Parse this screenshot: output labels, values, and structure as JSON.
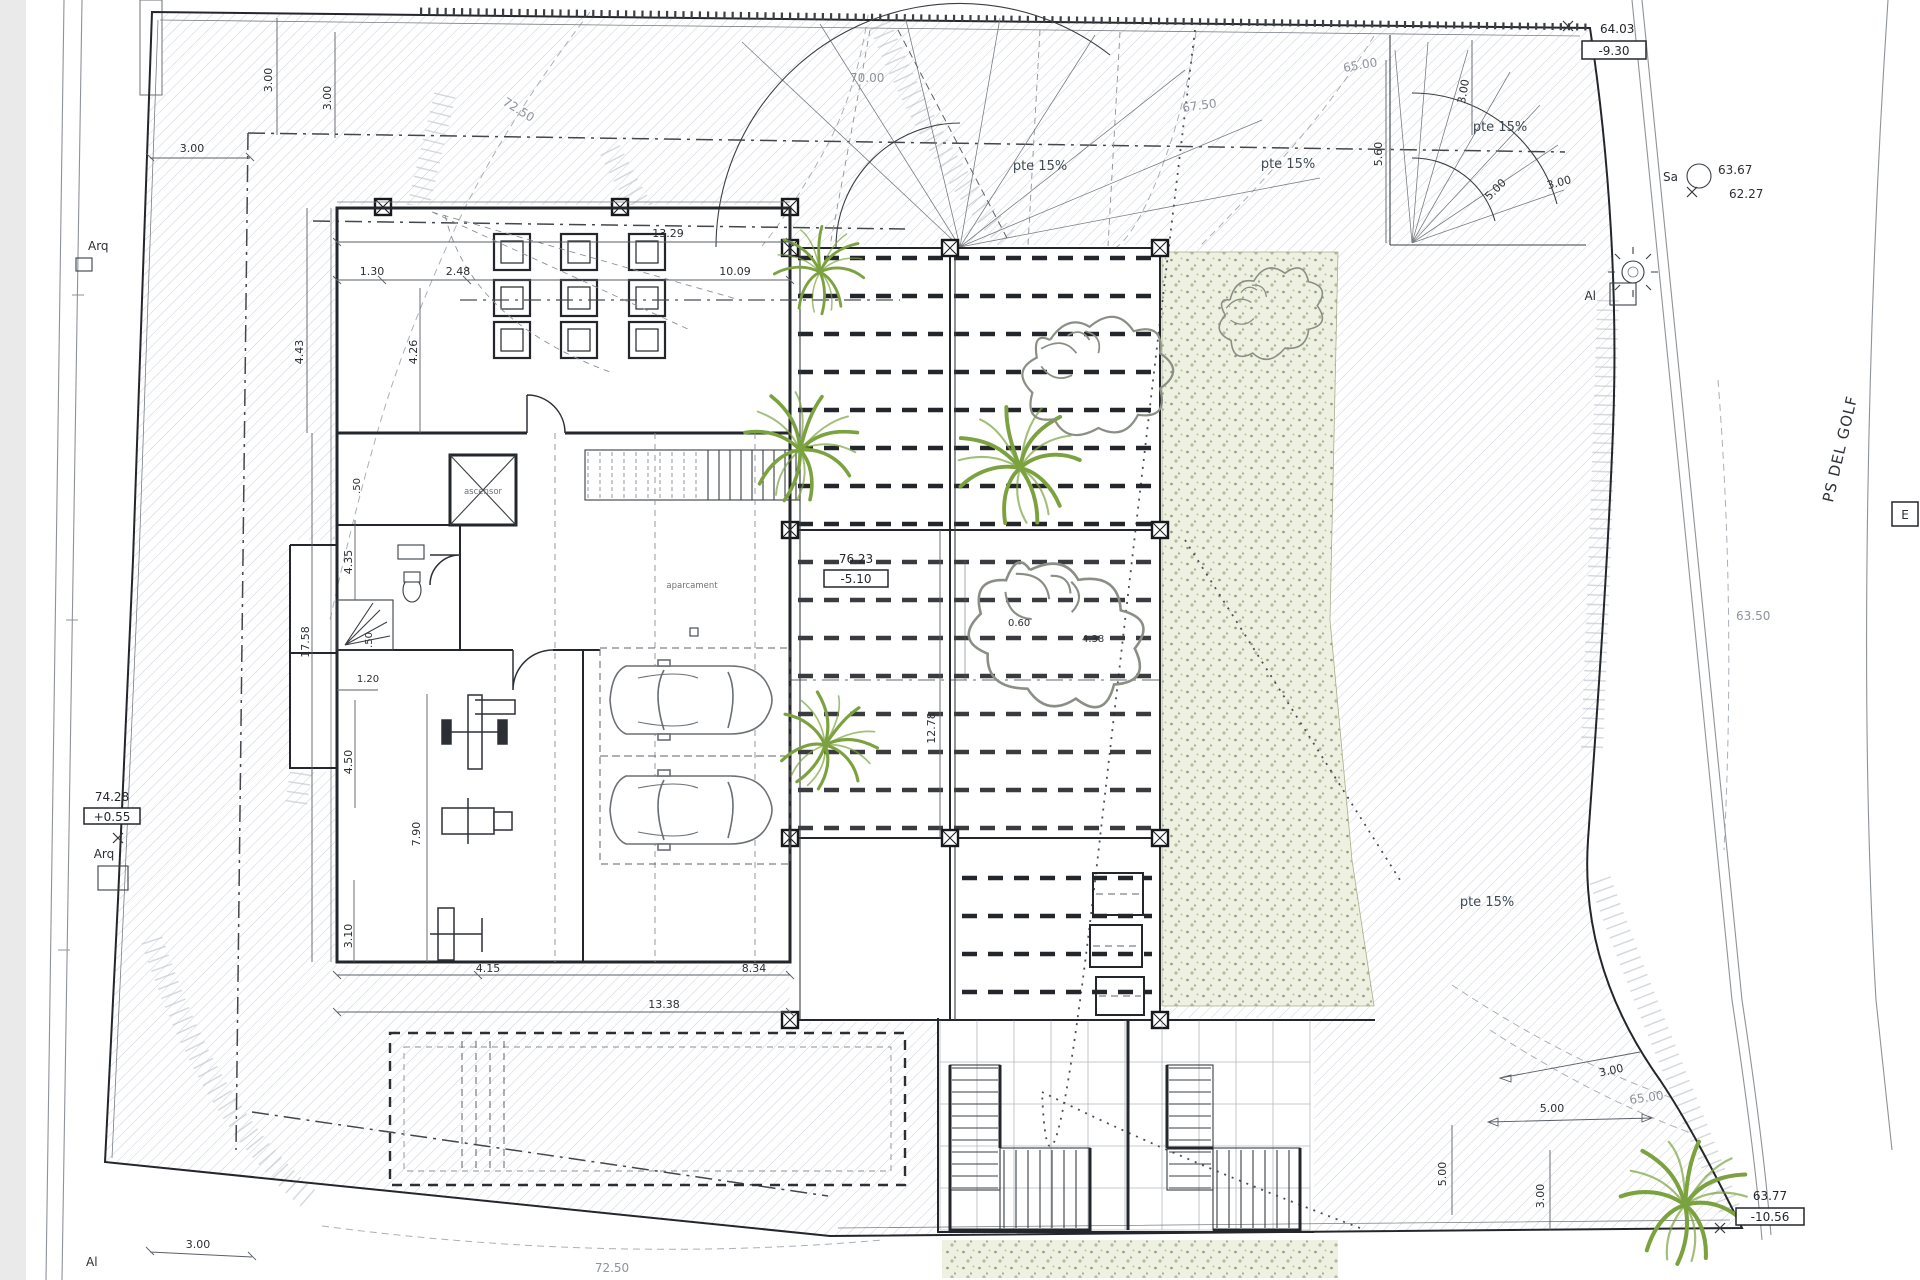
{
  "drawing": {
    "street_label": "PS DEL GOLF",
    "slope_labels": {
      "a": "pte 15%",
      "b": "pte 15%",
      "c": "pte 15%",
      "d": "pte 15%"
    },
    "contour_labels": {
      "c72_top": "72.50",
      "c70": "70.00",
      "c67": "67.50",
      "c65_top": "65.00",
      "c65_bot": "65.00",
      "c72_bot": "72.50",
      "c63_50": "63.50"
    },
    "level_markers": {
      "top_right": {
        "elev": "64.03",
        "rel": "-9.30"
      },
      "survey": {
        "label": "Sa",
        "v1": "63.67",
        "v2": "62.27"
      },
      "left": {
        "elev": "74.28",
        "rel": "+0.55"
      },
      "interior": {
        "elev": "76.23",
        "rel": "-5.10"
      },
      "bottom_right": {
        "elev": "63.77",
        "rel": "-10.56"
      }
    },
    "point_labels": {
      "arq_top": "Arq",
      "arq_left": "Arq",
      "al_bottom": "Al",
      "al_right": "Al",
      "e_box": "E"
    },
    "rooms": {
      "elevator": "ascensor",
      "garage": "aparcament"
    },
    "dims": {
      "d3a": "3.00",
      "d3b": "3.00",
      "d3c": "3.00",
      "d13_29": "13.29",
      "d1_30": "1.30",
      "d2_48": "2.48",
      "d10_09": "10.09",
      "d4_43": "4.43",
      "d4_26": "4.26",
      "d0_50a": ".50",
      "d0_50b": ".50",
      "d4_35": "4.35",
      "d17_58": "17.58",
      "d1_20": "1.20",
      "d4_50": "4.50",
      "d7_90": "7.90",
      "d3_10": "3.10",
      "d4_15": "4.15",
      "d8_34": "8.34",
      "d13_38": "13.38",
      "d12_78": "12.78",
      "d0_60": "0.60",
      "d4_38": "4.38",
      "d5_60": "5.60",
      "d3v": "3.00",
      "d5f": "5.00",
      "d3f": "3.00",
      "d5br_h": "5.00",
      "d5br_v": "5.00",
      "d3br_a": "3.00",
      "d3br_b": "3.00",
      "d3bl": "3.00"
    },
    "colors": {
      "tree_green": "#7ba23f",
      "tree_green_light": "#a3c168",
      "garden_bg": "#eef0e1",
      "garden_dot": "#8f9b72",
      "ink": "#23262a",
      "paper": "#ffffff"
    }
  }
}
